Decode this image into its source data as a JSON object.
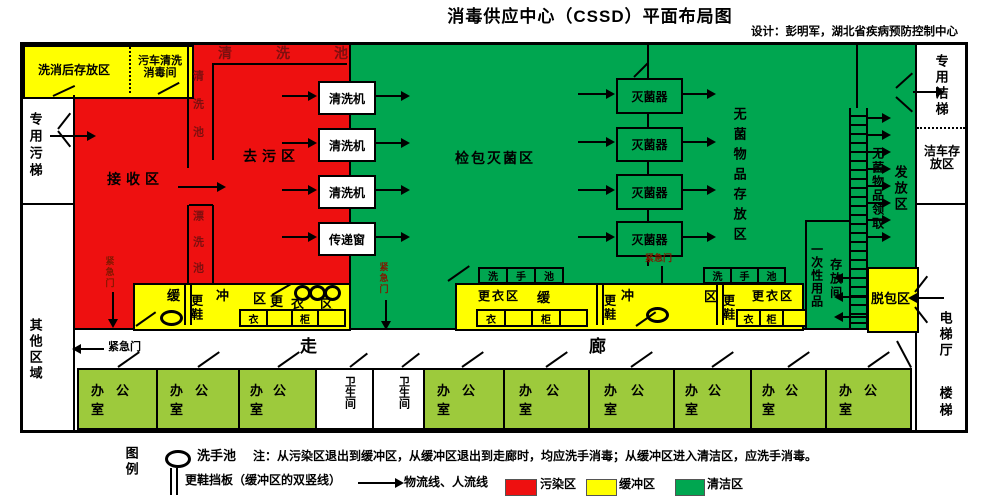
{
  "header": {
    "title": "消毒供应中心（CSSD）平面布局图",
    "credit": "设计：彭明军，湖北省疾病预防控制中心"
  },
  "colors": {
    "contaminated_zone": "#ee1010",
    "buffer_zone": "#ffff00",
    "clean_zone": "#00a650",
    "office_room": "#9dca3c",
    "emergency_text": "#801800"
  },
  "left_wing": {
    "dirty_elevator": "专用污梯",
    "other_area": "其他区域",
    "post_wash_storage": "洗消后存放区",
    "dirty_cart_wash_room": "污车清洗消毒间"
  },
  "contaminated_zone": {
    "receiving_area": "接收区",
    "decontamination_area": "去污区",
    "washing_sink_top": "清洗池",
    "washing_sink_left": "清洗池",
    "rinsing_sink": "漂洗池",
    "emergency_door": "紧急门"
  },
  "clean_zone": {
    "inspection_packing_sterilization_area": "检包灭菌区",
    "sterile_goods_storage_area": "无菌物品存放区",
    "dispensing_area": "发放区",
    "sterile_goods_pickup": "无菌物品领取",
    "disposable_goods": "一次性用品",
    "storage_room": "存放间",
    "emergency_door": "紧急门"
  },
  "equipment": {
    "washer": "清洗机",
    "transfer_window": "传递窗",
    "sterilizer": "灭菌器",
    "hand_sink": [
      "洗",
      "手",
      "池"
    ]
  },
  "buffer": {
    "huan": "缓",
    "chong": "冲",
    "qu": "区",
    "geng": "更",
    "yi": "衣",
    "change_shoes": "更鞋",
    "changing_area": "更衣区",
    "locker_yi": "衣",
    "locker_gui": "柜",
    "unpacking_area": "脱包区"
  },
  "right_wing": {
    "clean_elevator": "专用洁梯",
    "clean_cart_storage": "洁车存放区",
    "elevator_hall": "电梯厅",
    "stairs": "楼梯"
  },
  "corridor": {
    "zou": "走",
    "lang": "廊",
    "emergency_door": "紧急门"
  },
  "bottom_row": {
    "rooms": [
      "办公室",
      "办公室",
      "办公室",
      "卫生间",
      "卫生间",
      "办公室",
      "办公室",
      "办公室",
      "办公室",
      "办公室",
      "办公室"
    ]
  },
  "legend": {
    "title": "图例",
    "hand_sink": "洗手池",
    "note": "注：从污染区退出到缓冲区，从缓冲区退出到走廊时，均应洗手消毒；从缓冲区进入清洁区，应洗手消毒。",
    "shoe_board": "更鞋挡板（缓冲区的双竖线）",
    "flow_line": "物流线、人流线",
    "contaminated": "污染区",
    "buffer": "缓冲区",
    "clean": "清洁区"
  }
}
